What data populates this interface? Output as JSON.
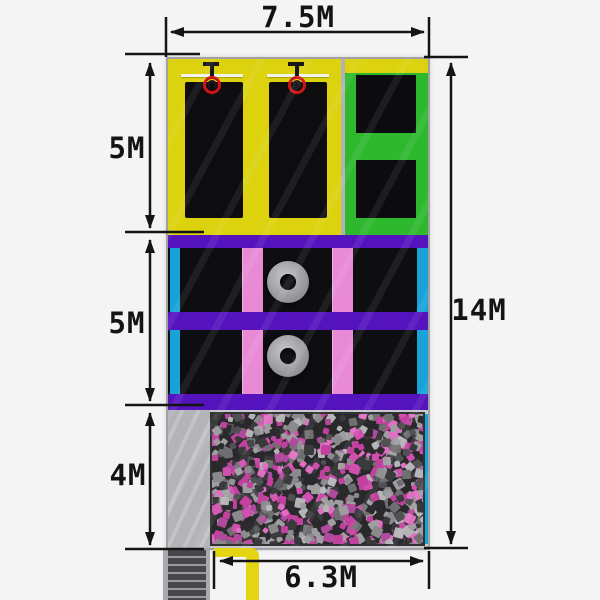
{
  "dimensions": {
    "top_width": "7.5M",
    "left_top_height": "5M",
    "left_middle_height": "5M",
    "left_bottom_height": "4M",
    "right_total_height": "14M",
    "bottom_width": "6.3M"
  },
  "zones": {
    "basketball_area": {
      "color": "#ddd20e",
      "courts": 2,
      "hoops": 2
    },
    "slam_area": {
      "color": "#2eb82e",
      "mats": 2
    },
    "trampoline_grid": {
      "frame_color": "#5513bd",
      "pad_color": "#e98ad6",
      "edge_color": "#18a3d8",
      "rows": 2,
      "foam_rings": 2
    },
    "foam_pit": {
      "foam_colors": [
        "#c2409e",
        "#d14fae",
        "#b04a9c",
        "#e06ec2",
        "#9e9ea1",
        "#b5b5b8",
        "#8a8a8d",
        "#6f6f72",
        "#3a3a3d",
        "#2b2b2e",
        "#515154",
        "#c2409e",
        "#9e9ea1",
        "#3a3a3d"
      ]
    },
    "walkway": {
      "color": "#b6b6ba"
    },
    "stairs": {
      "steps": 6
    },
    "entry_path": {
      "color": "#e3d414"
    }
  },
  "style": {
    "background": "#f4f4f5",
    "wall_color": "#a2a2a6",
    "dimension_color": "#141414",
    "hoop_ring_color": "#cf1414"
  }
}
